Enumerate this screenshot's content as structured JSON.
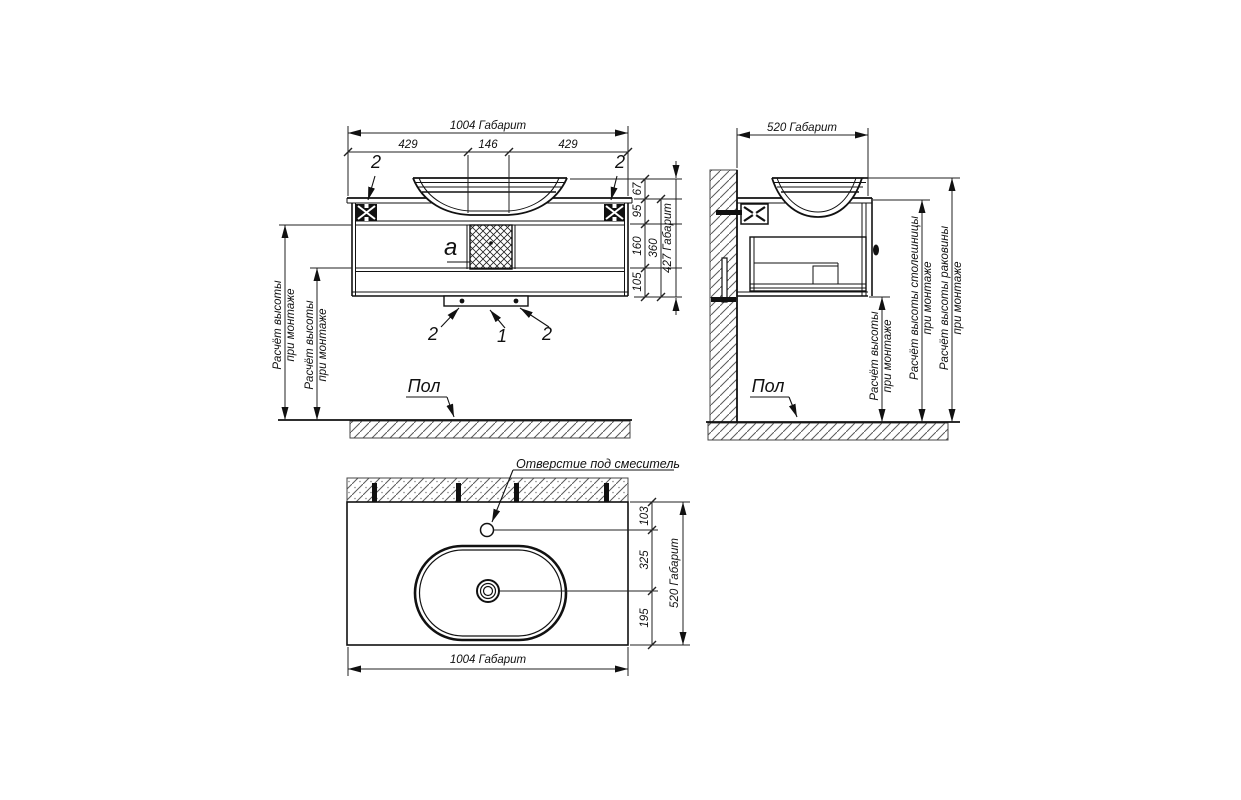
{
  "front_view": {
    "dim_total_width": "1004 Габарит",
    "dim_left": "429",
    "dim_center": "146",
    "dim_right": "429",
    "dim_sink_height": "67",
    "dim_top_section": "95",
    "dim_middle_section": "160",
    "dim_bottom_section": "105",
    "dim_cabinet_height": "360",
    "dim_total_height": "427 Габарит",
    "callout_bracket_left": "2",
    "callout_bracket_right": "2",
    "callout_bottom_left": "2",
    "callout_bottom_center": "1",
    "callout_bottom_right": "2",
    "section_label": "a",
    "height_note": {
      "line1": "Расчёт высоты",
      "line2": "при монтаже"
    },
    "height_note_2": {
      "line1": "Расчёт высоты",
      "line2": "при монтаже"
    },
    "floor_label": "Пол"
  },
  "side_view": {
    "dim_total_depth": "520 Габарит",
    "note_cabinet_height": {
      "line1": "Расчёт высоты",
      "line2": "при монтаже"
    },
    "note_countertop_height": {
      "line1": "Расчёт высоты столешницы",
      "line2": "при монтаже"
    },
    "note_sink_height": {
      "line1": "Расчёт высоты раковины",
      "line2": "при монтаже"
    },
    "floor_label": "Пол"
  },
  "plan_view": {
    "faucet_hole_label": "Отверстие под смеситель",
    "dim_faucet_offset": "103",
    "dim_drain_offset": "325",
    "dim_front_offset": "195",
    "dim_total_depth": "520 Габарит",
    "dim_total_width": "1004 Габарит"
  }
}
